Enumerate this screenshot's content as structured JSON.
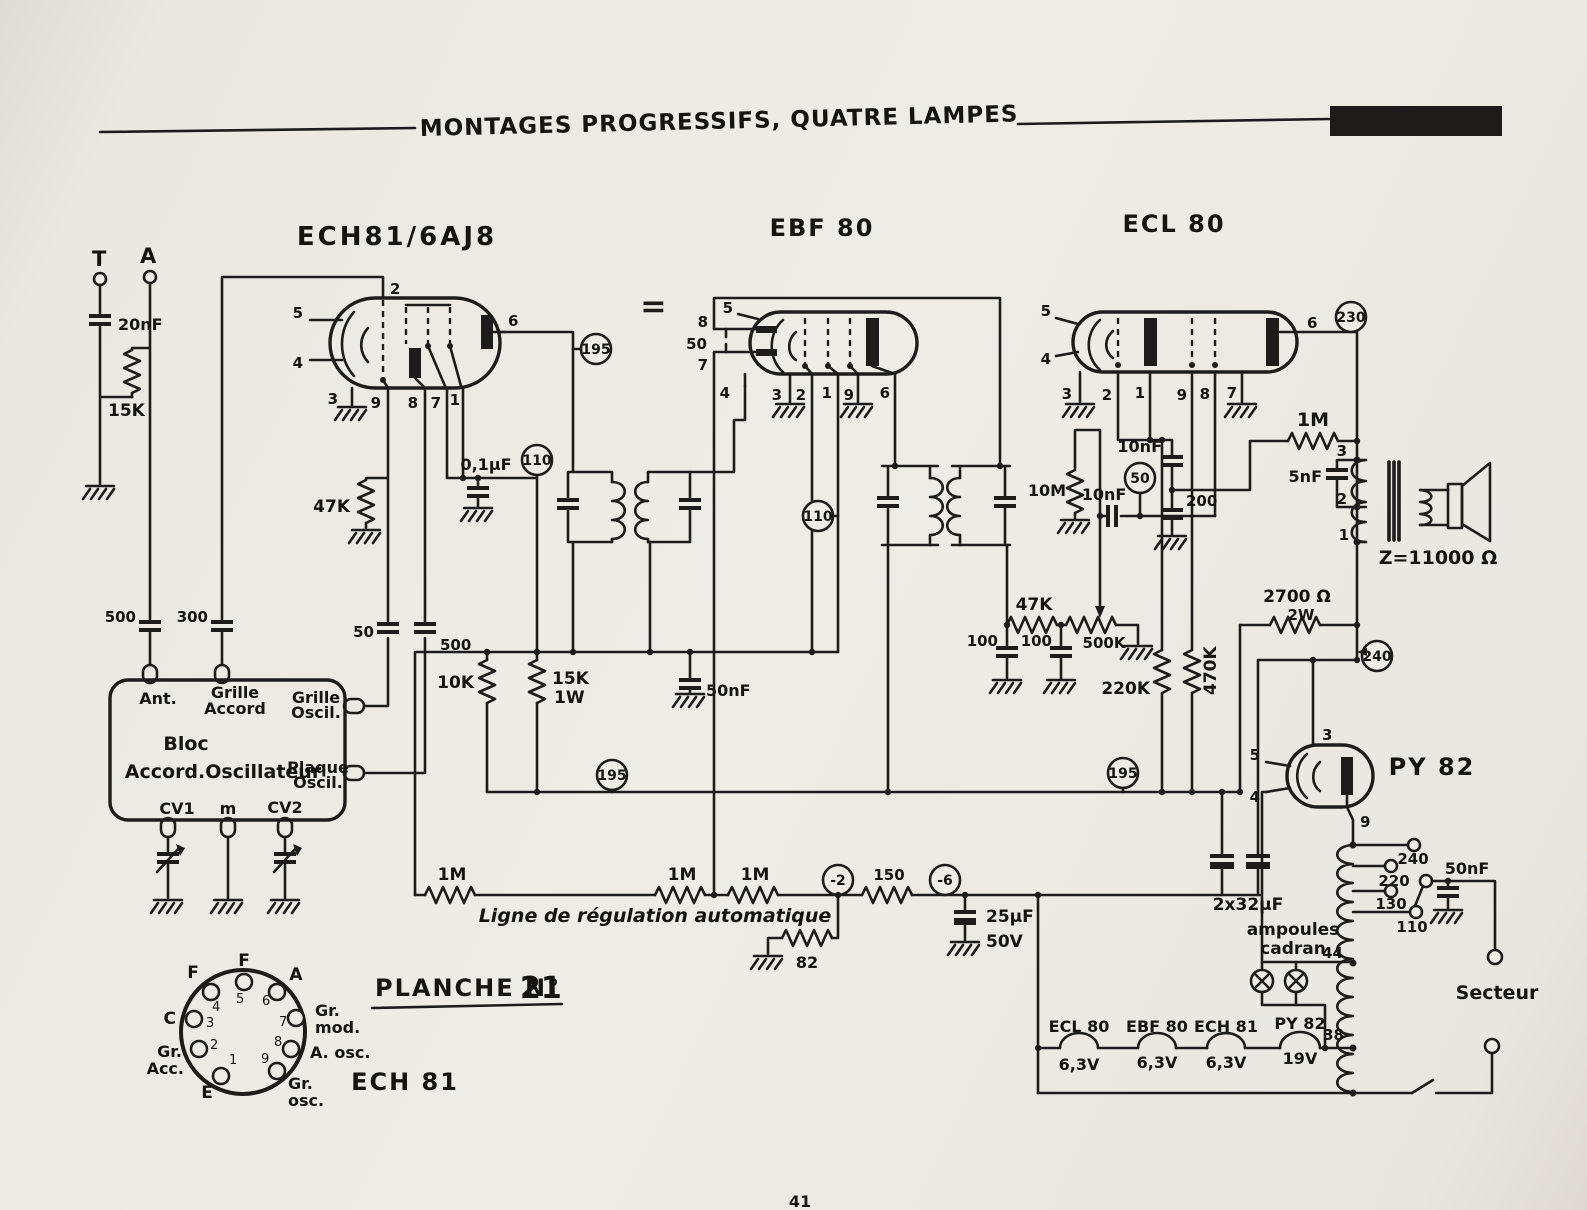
{
  "header": {
    "title": "MONTAGES PROGRESSIFS, QUATRE LAMPES"
  },
  "page": {
    "num": "41"
  },
  "plate": {
    "title": "PLANCHE N°",
    "num": "21",
    "tube": "ECH 81"
  },
  "tubes": {
    "t1": "ECH81/6AJ8",
    "t2": "EBF 80",
    "t3": "ECL 80",
    "t4": "PY 82"
  },
  "pins": {
    "n1": "1",
    "n2": "2",
    "n3": "3",
    "n4": "4",
    "n5": "5",
    "n6": "6",
    "n7": "7",
    "n8": "8",
    "n9": "9"
  },
  "tp": {
    "v110": "110",
    "v195": "195",
    "v230": "230",
    "v240": "240",
    "v50": "50",
    "m2": "-2",
    "m6": "-6"
  },
  "ant": {
    "t": "T",
    "a": "A"
  },
  "c": {
    "c20n": "20nF",
    "r15k": "15K",
    "r47k": "47K",
    "c01": "0,1µF",
    "c500a": "500",
    "c300": "300",
    "c50osc": "50",
    "c500osc": "500",
    "r10k": "10K",
    "r15k1w": "15K",
    "w1w": "1W",
    "c50n": "50nF",
    "c50d": "50",
    "r10m": "10M",
    "c10n": "10nF",
    "r47k2": "47K",
    "c100": "100",
    "pot": "500K",
    "c200": "200",
    "r220k": "220K",
    "r470k": "470K",
    "r1m": "1M",
    "c5n": "5nF",
    "z": "Z=11000 Ω",
    "r2700": "2700 Ω",
    "r2700w": "2W",
    "r150": "150",
    "r82": "82",
    "c25": "25µF",
    "v50v": "50V",
    "c2x32": "2x32µF"
  },
  "bloc": {
    "ant": "Ant.",
    "g1": "Grille",
    "g2": "Accord",
    "go1": "Grille",
    "go2": "Oscil.",
    "name1": "Bloc",
    "name2": "Accord.Oscillateur",
    "po1": "Plaque",
    "po2": "Oscil.",
    "cv1": "CV1",
    "m": "m",
    "cv2": "CV2"
  },
  "avc": {
    "line": "Ligne de régulation automatique"
  },
  "power": {
    "t240": "240",
    "t220": "220",
    "t130": "130",
    "t110": "110",
    "t44": "44",
    "t38": "38",
    "secteur": "Secteur",
    "lamp1": "ampoules",
    "lamp2": "cadran",
    "h1": "ECL 80",
    "h2": "EBF 80",
    "h3": "ECH 81",
    "h4": "PY 82",
    "v63": "6,3V",
    "v19": "19V"
  },
  "socket": {
    "f": "F",
    "a": "A",
    "c": "C",
    "e": "E",
    "gr": "Gr.",
    "mod": "mod.",
    "acc": "Acc.",
    "aosc": "A. osc.",
    "osc": "osc."
  }
}
